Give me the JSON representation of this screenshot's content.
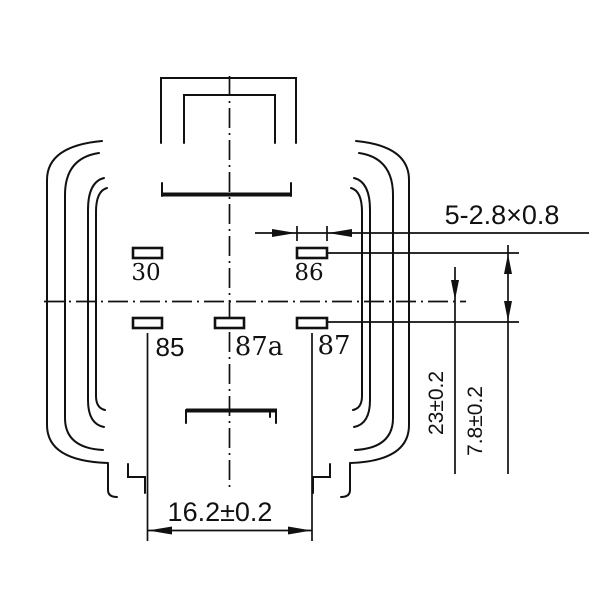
{
  "drawing": {
    "type": "relay-footprint-bottom-view",
    "colors": {
      "line": "#111111",
      "background": "#ffffff"
    }
  },
  "pins": [
    {
      "id": "30",
      "label": "30"
    },
    {
      "id": "86",
      "label": "86"
    },
    {
      "id": "85",
      "label": "85"
    },
    {
      "id": "87a",
      "label": "87a"
    },
    {
      "id": "87",
      "label": "87"
    }
  ],
  "dimensions": {
    "terminal_size": "5-2.8×0.8",
    "terminal_spacing_horizontal": "16.2±0.2",
    "terminal_length_vertical": "23±0.2",
    "row_spacing_vertical": "7.8±0.2"
  }
}
